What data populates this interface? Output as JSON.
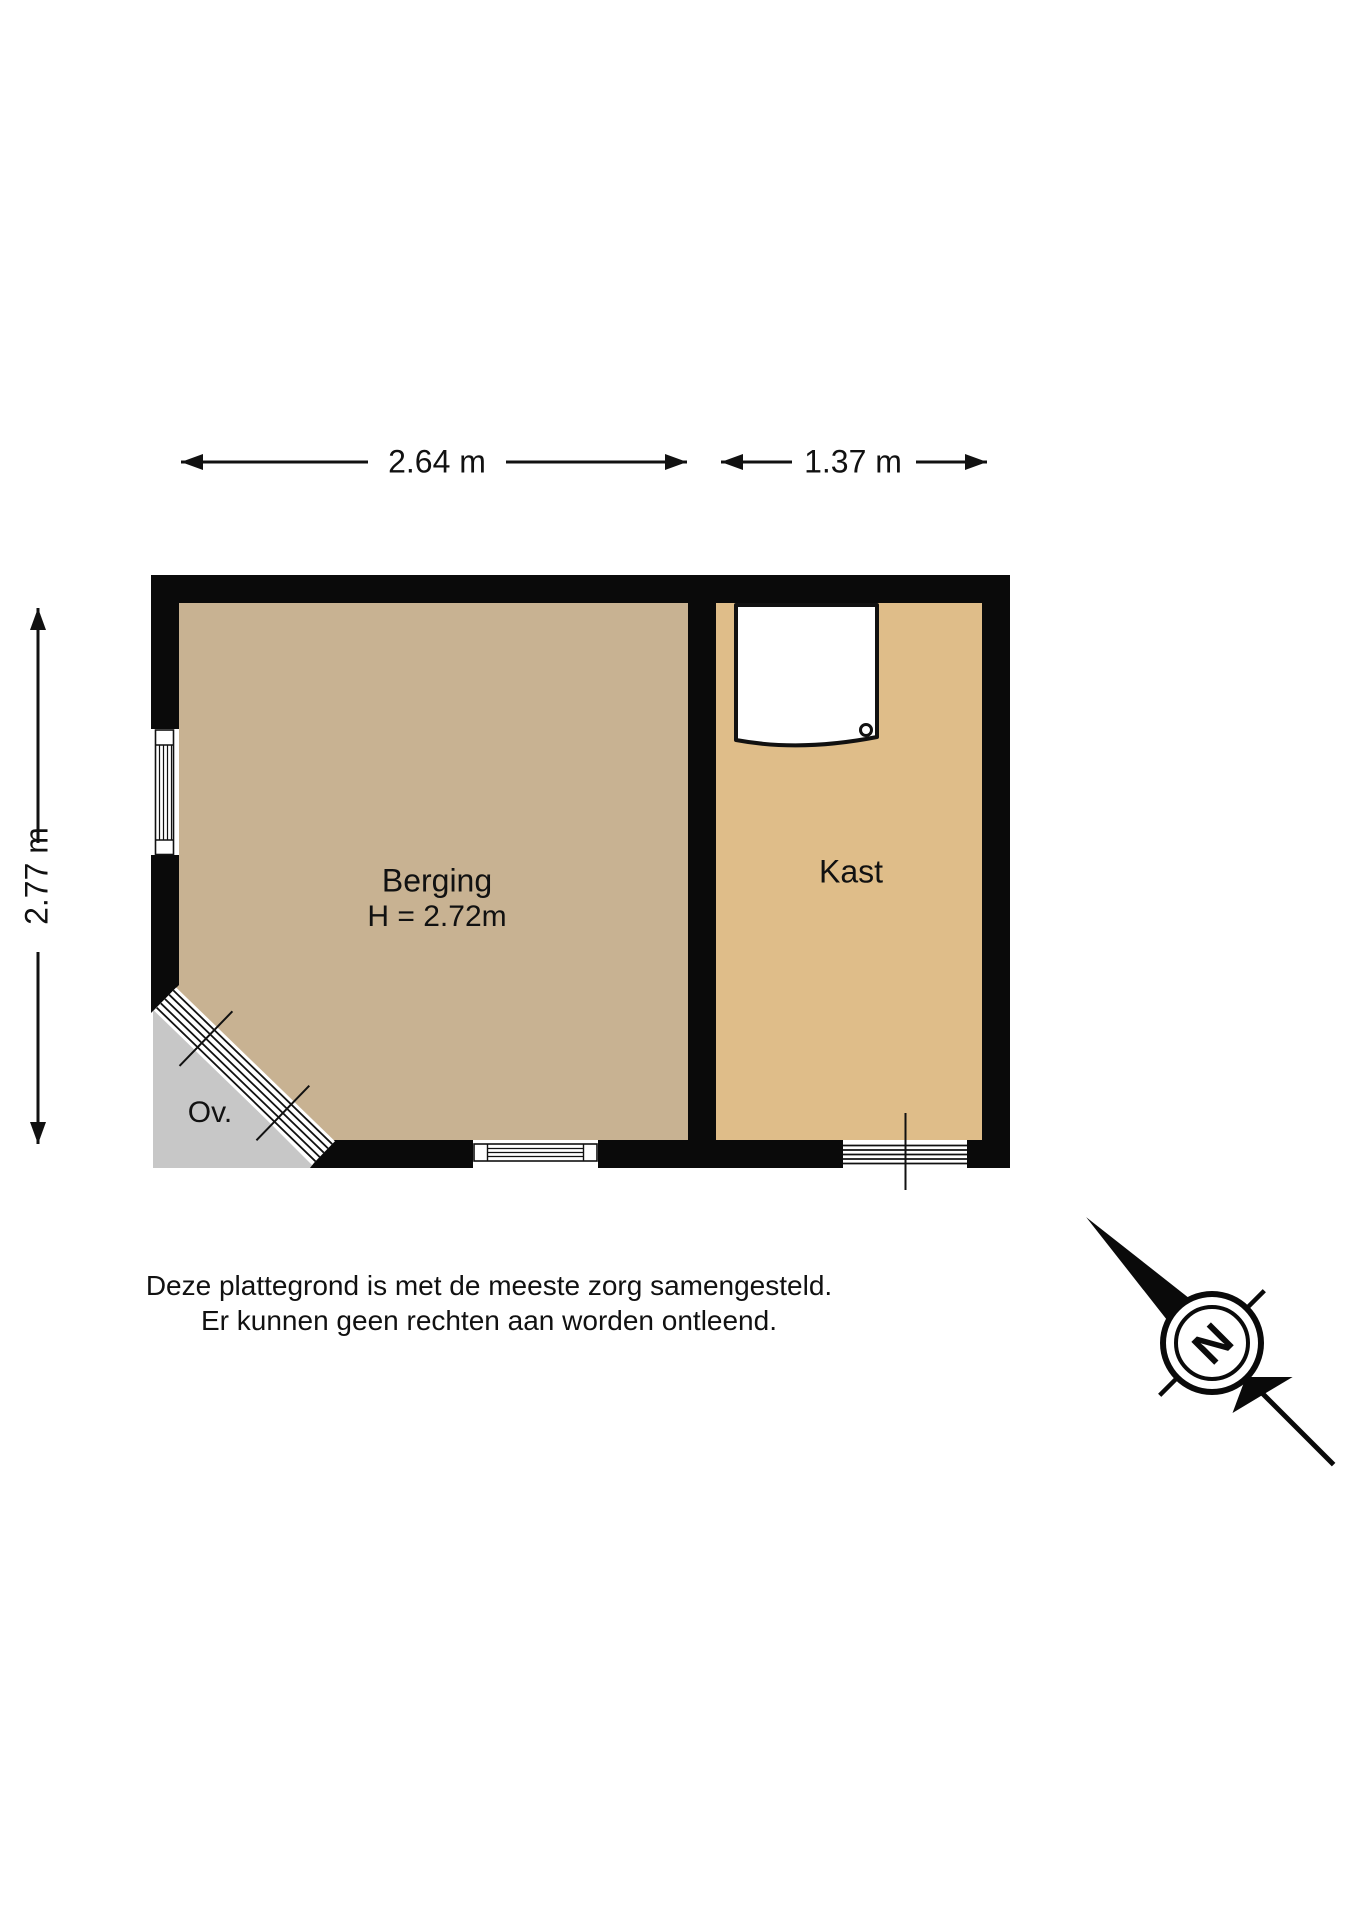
{
  "floorplan": {
    "dimension_labels": {
      "berging_width": "2.64 m",
      "kast_width": "1.37 m",
      "total_depth": "2.77 m"
    },
    "rooms": {
      "berging": {
        "name": "Berging",
        "ceiling_height": "H = 2.72m"
      },
      "kast": {
        "name": "Kast"
      },
      "overig": {
        "name": "Ov."
      }
    },
    "compass": {
      "north": "N"
    },
    "disclaimer": {
      "line1": "Deze plattegrond is met de meeste zorg samengesteld.",
      "line2": "Er kunnen geen rechten aan worden ontleend."
    },
    "colors": {
      "berging_floor": "#C8B292",
      "kast_floor": "#DFBD89",
      "ov_area": "#C7C7C7",
      "wall": "#0a0a0a",
      "line": "#111111"
    }
  }
}
